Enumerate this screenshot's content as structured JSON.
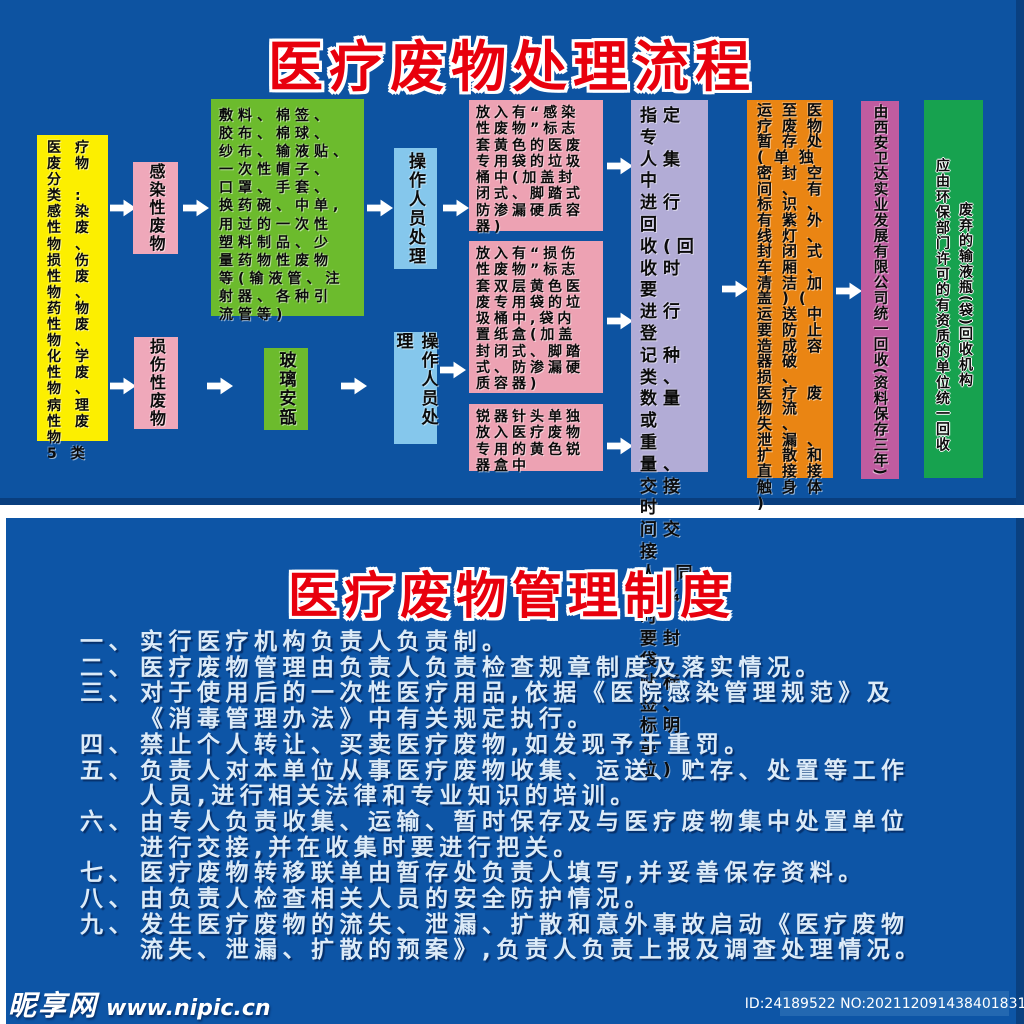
{
  "top": {
    "title": "医疗废物处理流程"
  },
  "flow": {
    "categories": "医疗\n废物\n分类:\n感染\n性废\n物、\n损伤\n性废\n物、\n药物\n性废\n物、\n化学\n性废\n物、\n病理\n性废\n物\n5类",
    "infectious_label": "感染性废物",
    "infectious_items": "敷料、棉签、\n胶布、棉球、\n纱布、输液贴、\n一次性帽子、\n口罩、手套、\n换药碗、中单,\n用过的一次性\n塑料制品、少\n量药物性废物\n等(输液管、注\n射器、各种引\n流管等)",
    "operator_label_1": "操作人员处理",
    "sharp_label": "损伤性废物",
    "glass_label": "玻璃安瓿",
    "operator_label_2": "操作人员处理",
    "bag_infectious": "放入有“感染\n性废物”标志\n套黄色的医废\n专用袋的垃圾\n桶中(加盖封\n闭式、脚踏式\n防渗漏硬质容\n器)",
    "bag_sharp": "放入有“损伤\n性废物”标志\n套双层黄色医\n废专用袋的垃\n圾桶中,袋内\n置纸盒(加盖\n封闭式、脚踏\n式、防渗漏硬\n质容器)",
    "sharps_container": "锐器针头单独\n放入医疗废物\n专用的黄色锐\n器盒中",
    "collection": "指定专\n人集中\n进行回\n收(回\n收时要\n进行登\n记种类、\n数量或\n重量、\n交接时\n间交接\n人,同\n时¾时\n要封袋、\n贴标签、\n标明单\n位)",
    "transport": "运至医\n疗废物\n暂存处\n(单独\n密封空\n间、有\n标识、\n有紫外\n线灯、\n封闭式\n车厢、\n清洁加\n盖)(\n运送中\n要防止\n造成容\n器破损、\n医疗废\n物流失、\n泄漏、\n扩散和\n直接接\n触身体\n)",
    "company": "由西安卫达实业发展有限公司统一回收(资料保存三年)",
    "recycler_note": "应由环保部门许可的有资质的单位统一回收",
    "recycler_org": "废弃的输液瓶(袋)回收机构"
  },
  "management": {
    "title": "医疗废物管理制度",
    "rules": [
      {
        "num": "一、",
        "text": "实行医疗机构负责人负责制。"
      },
      {
        "num": "二、",
        "text": "医疗废物管理由负责人负责检查规章制度及落实情况。"
      },
      {
        "num": "三、",
        "text": "对于使用后的一次性医疗用品,依据《医院感染管理规范》及\n《消毒管理办法》中有关规定执行。"
      },
      {
        "num": "四、",
        "text": "禁止个人转让、买卖医疗废物,如发现予于重罚。"
      },
      {
        "num": "五、",
        "text": "负责人对本单位从事医疗废物收集、运送、贮存、处置等工作\n人员,进行相关法律和专业知识的培训。"
      },
      {
        "num": "六、",
        "text": "由专人负责收集、运输、暂时保存及与医疗废物集中处置单位\n进行交接,并在收集时要进行把关。"
      },
      {
        "num": "七、",
        "text": "医疗废物转移联单由暂存处负责人填写,并妥善保存资料。"
      },
      {
        "num": "八、",
        "text": "由负责人检查相关人员的安全防护情况。"
      },
      {
        "num": "九、",
        "text": "发生医疗废物的流失、泄漏、扩散和意外事故启动《医疗废物\n流失、泄漏、扩散的预案》,负责人负责上报及调查处理情况。"
      }
    ]
  },
  "watermark": {
    "site_name": "昵享网",
    "site_url": "www.nipic.cn",
    "id_badge": "ID:24189522 NO:20211209143840183104"
  },
  "colors": {
    "panel_blue": "#0d53a1",
    "title_red": "#e8000d",
    "yellow": "#fcef00",
    "pink": "#efa8ba",
    "green": "#6cbb2d",
    "light_blue": "#85c7ec",
    "lavender": "#b2acd6",
    "orange": "#ea8513",
    "magenta": "#c05ca0",
    "deep_green": "#17a24f"
  }
}
